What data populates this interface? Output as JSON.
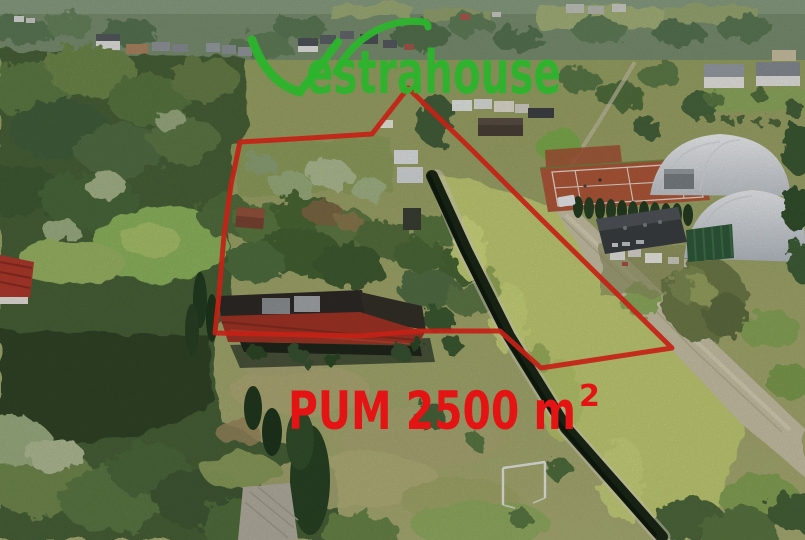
{
  "scene": {
    "type": "aerial-drone-photo",
    "description": "Aerial view of a residential building plot outlined in red, with a single-storey house with a red tiled roof, lawns, dense trees on the left, neighbouring clay tennis courts, two white sports domes, allotments and a gravel road on the right"
  },
  "watermark": {
    "brand_full": "Vestrahouse",
    "brand_initial": "V",
    "brand_rest": "estrahouse",
    "color": "#2db52d"
  },
  "area_overlay": {
    "label": "PUM 2500 m",
    "superscript": "2",
    "full_text": "PUM 2500 m²",
    "color": "#e41414"
  },
  "boundary": {
    "color": "#e6281a"
  }
}
